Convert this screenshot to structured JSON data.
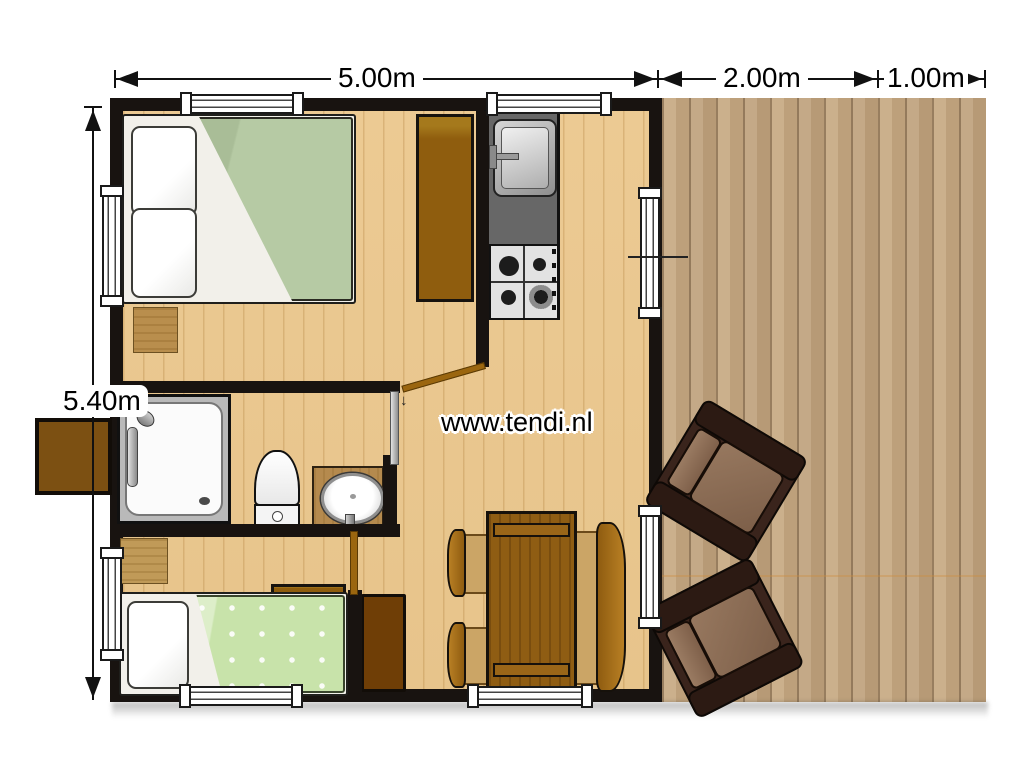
{
  "watermark": {
    "text": "www.tendi.nl"
  },
  "dimensions": {
    "top": [
      {
        "label": "5.00m"
      },
      {
        "label": "2.00m"
      },
      {
        "label": "1.00m"
      }
    ],
    "left": {
      "label": "5.40m"
    }
  },
  "floorplan": {
    "type": "lodge-tent floor plan, top view",
    "cabin_size": {
      "width_m": 5.0,
      "depth_m": 5.4
    },
    "deck_size": {
      "width_m": 2.0,
      "extra_width_m": 1.0
    },
    "rooms": [
      {
        "name": "bedroom-double",
        "contents": [
          "double-bed",
          "bedside-mat",
          "wardrobe"
        ]
      },
      {
        "name": "kitchen",
        "contents": [
          "kitchen-sink",
          "gas-stove-4-burners",
          "counter"
        ]
      },
      {
        "name": "bathroom",
        "contents": [
          "shower",
          "toilet",
          "washbasin"
        ]
      },
      {
        "name": "bedroom-single",
        "contents": [
          "single-bed",
          "bedside-mat",
          "head-shelf"
        ]
      },
      {
        "name": "living-dining",
        "contents": [
          "dining-table",
          "chair",
          "chair",
          "bench",
          "side-cabinet"
        ]
      },
      {
        "name": "deck",
        "contents": [
          "armchair",
          "armchair"
        ]
      },
      {
        "name": "exterior",
        "contents": [
          "entry-step"
        ]
      }
    ],
    "openings": {
      "windows": 8,
      "interior_doors": 3
    },
    "colors": {
      "wall": "#181310",
      "interior_floor": "#ecca93",
      "deck_floor": "#c4a987",
      "duvet_double": "#b6caa4",
      "blanket_single": "#c8e3aa",
      "counter_gray": "#676767",
      "wood_furniture": "#8f5d13",
      "armchair_frame": "#3a241c",
      "armchair_cushion": "#8f7058"
    }
  }
}
